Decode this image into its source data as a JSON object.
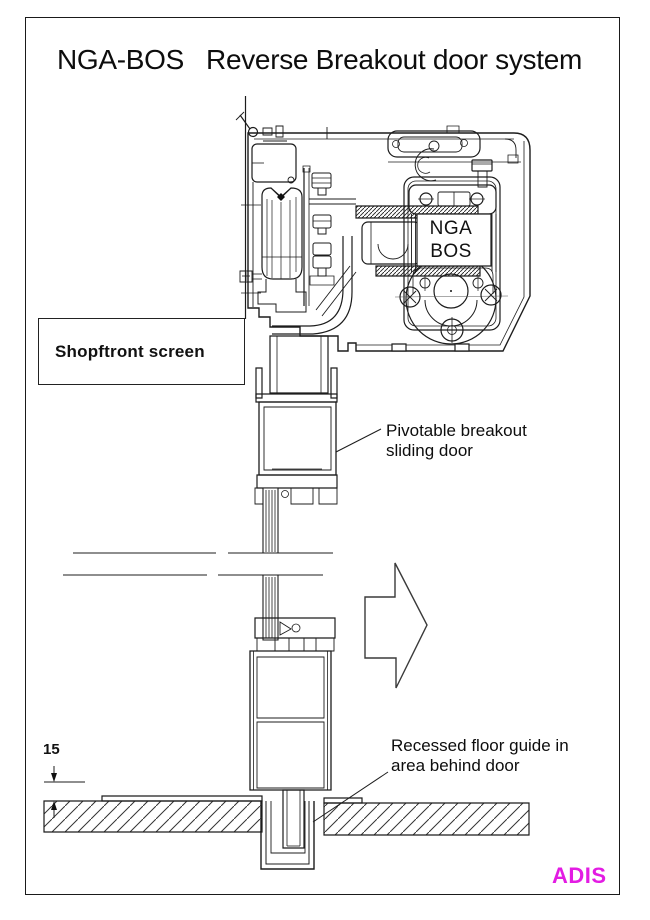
{
  "title": {
    "part1": "NGA-BOS",
    "part2": "Reverse Breakout door system"
  },
  "labels": {
    "shopfront": "Shopftront screen",
    "pivot_line1": "Pivotable breakout",
    "pivot_line2": "sliding door",
    "floor_line1": "Recessed floor guide in",
    "floor_line2": "area behind door",
    "dimension": "15"
  },
  "operator": {
    "line1": "NGA",
    "line2": "BOS"
  },
  "brand": {
    "text": "ADIS",
    "color": "#E31CE3"
  },
  "drawing": {
    "line_color": "#1c1c1c",
    "background": "#ffffff"
  }
}
